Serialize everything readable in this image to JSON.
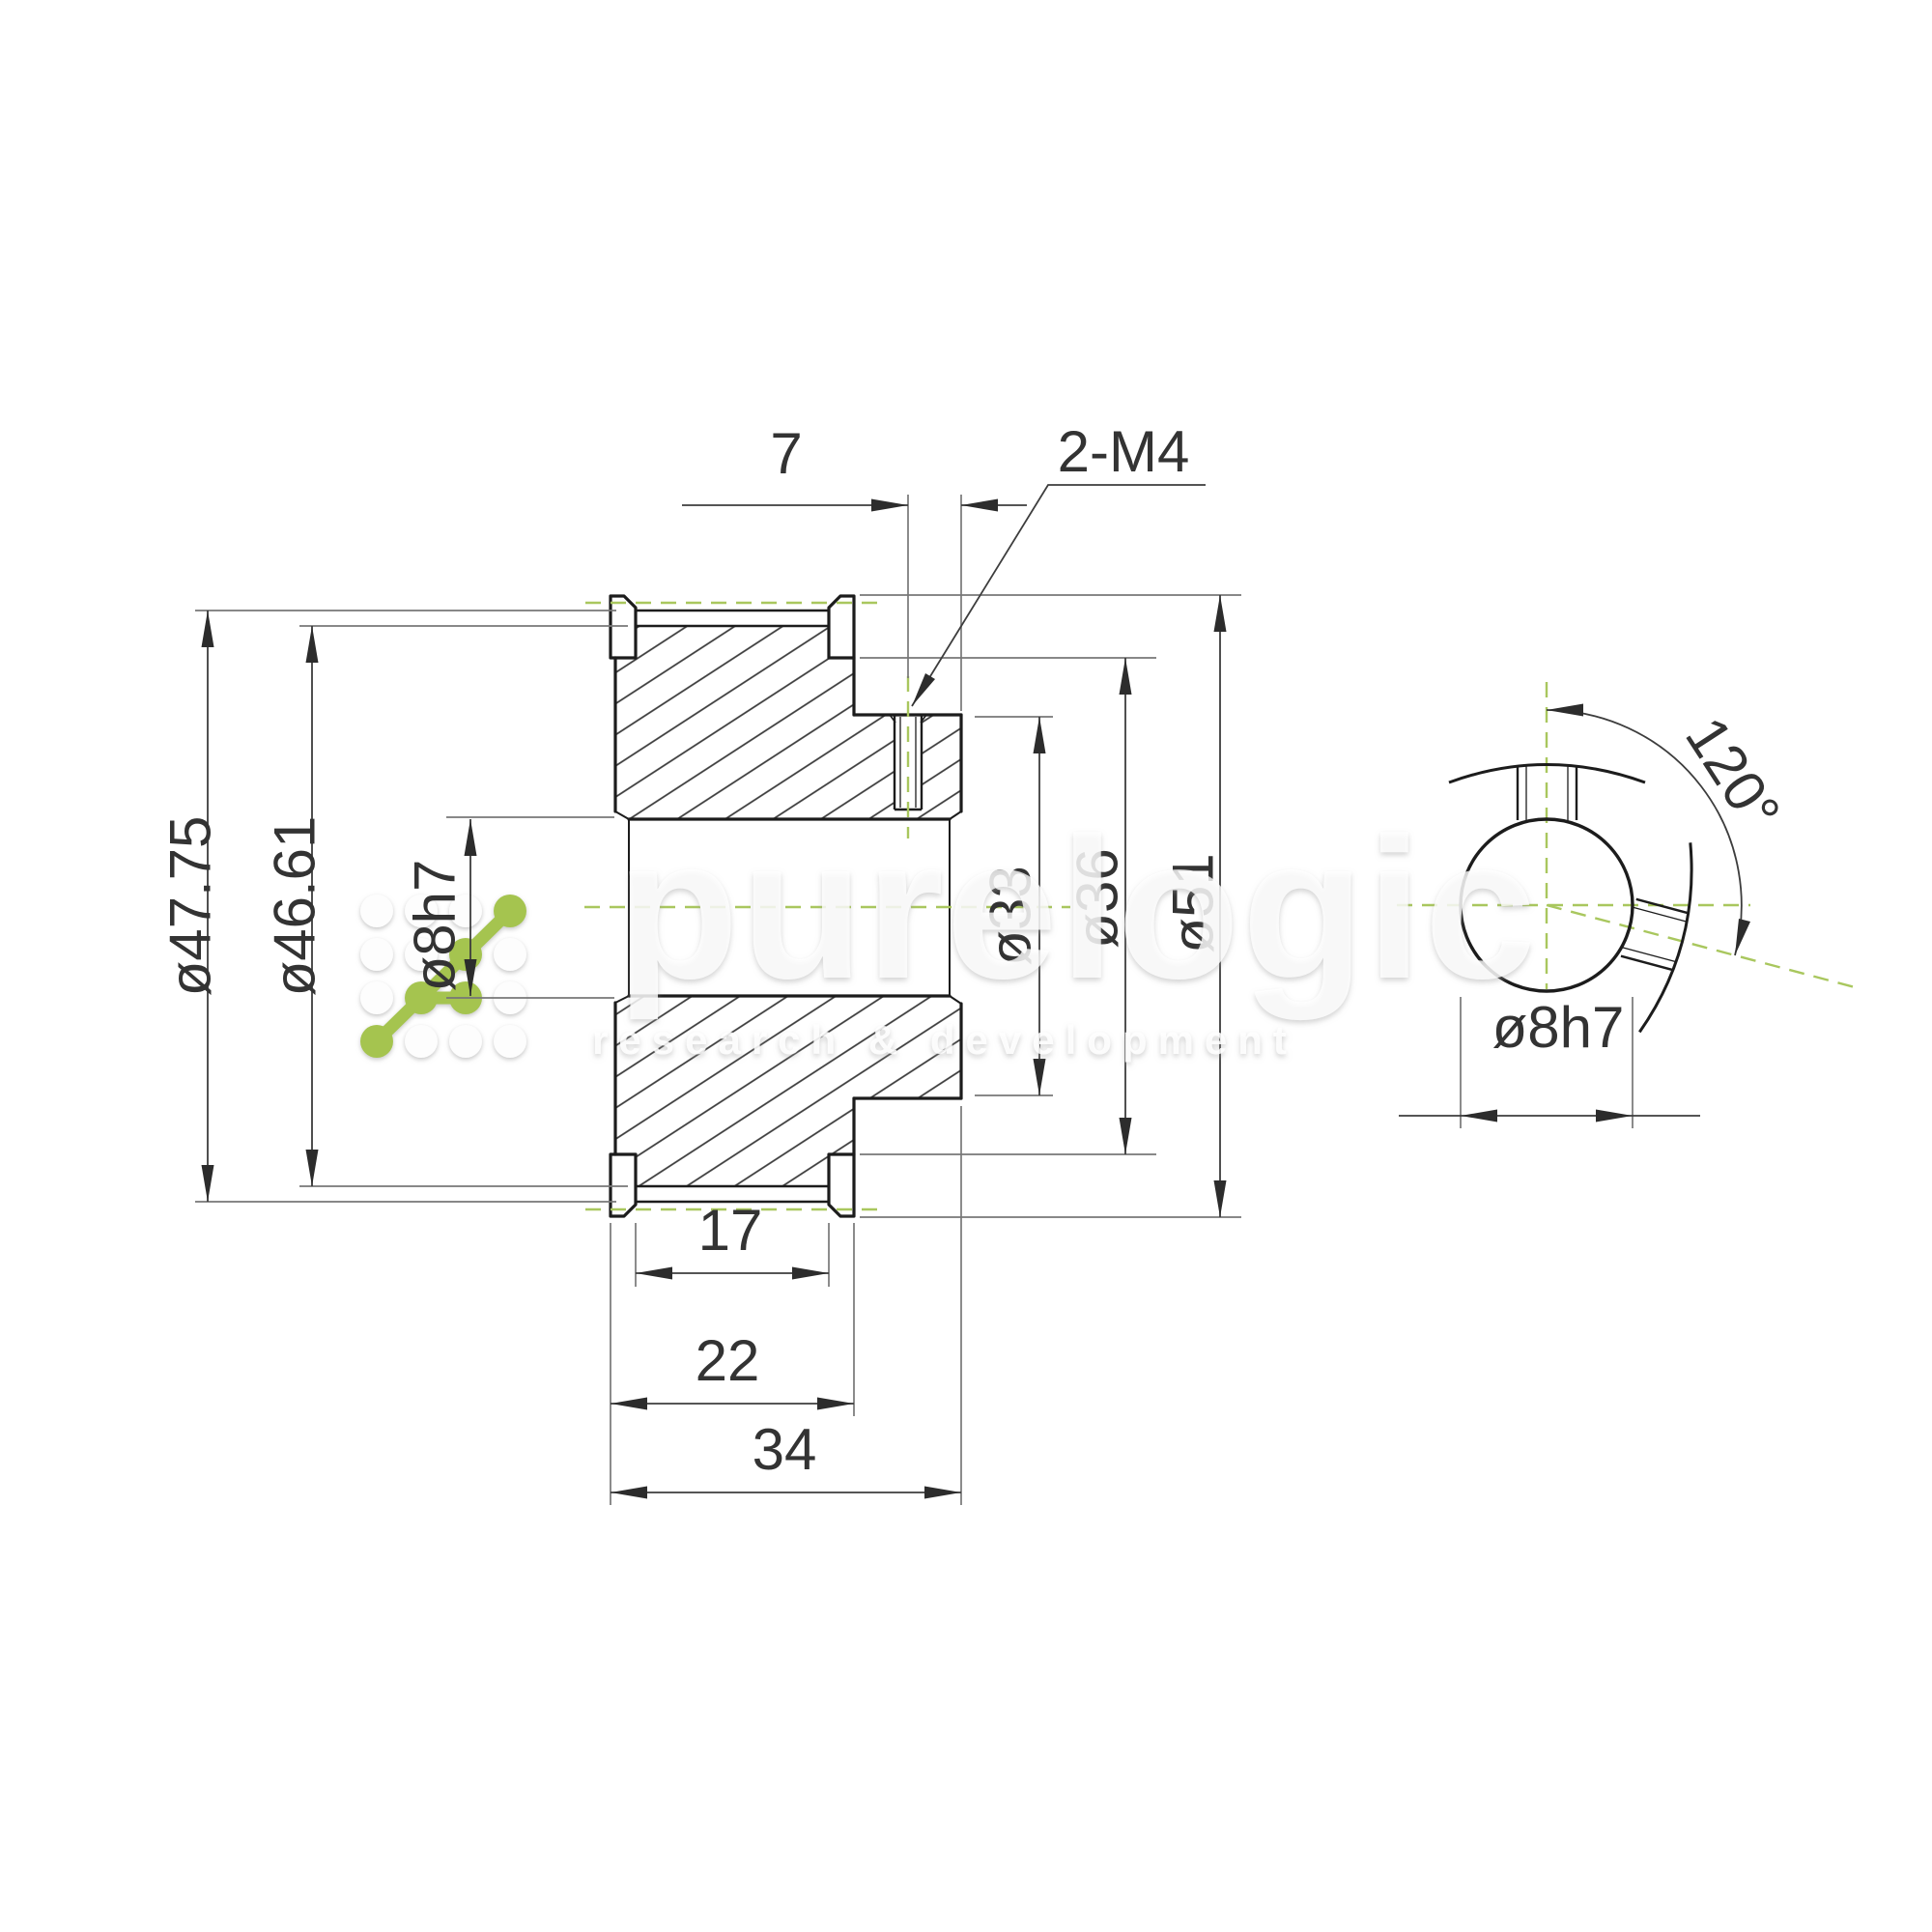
{
  "watermark": {
    "brand": "purelogic",
    "tagline": "research & development"
  },
  "section_view": {
    "dimensions": {
      "outside_diameter": "ø47.75",
      "root_diameter": "ø46.61",
      "bore": "ø8h7",
      "setscrew_offset": "7",
      "setscrew_thread": "2-M4",
      "recess_diameter": "ø33",
      "hub_diameter": "ø36",
      "flange_diameter": "ø51",
      "belt_width": "17",
      "flange_width": "22",
      "overall_length": "34"
    }
  },
  "end_view": {
    "dimensions": {
      "bore": "ø8h7",
      "setscrew_angle": "120°"
    }
  },
  "style": {
    "centerline_color": "#a9c75e",
    "logo_green": "#a5c44f",
    "outline_color": "#1c1c1c",
    "dim_line_color": "#3d3d3d",
    "extension_line_color": "#777777"
  }
}
